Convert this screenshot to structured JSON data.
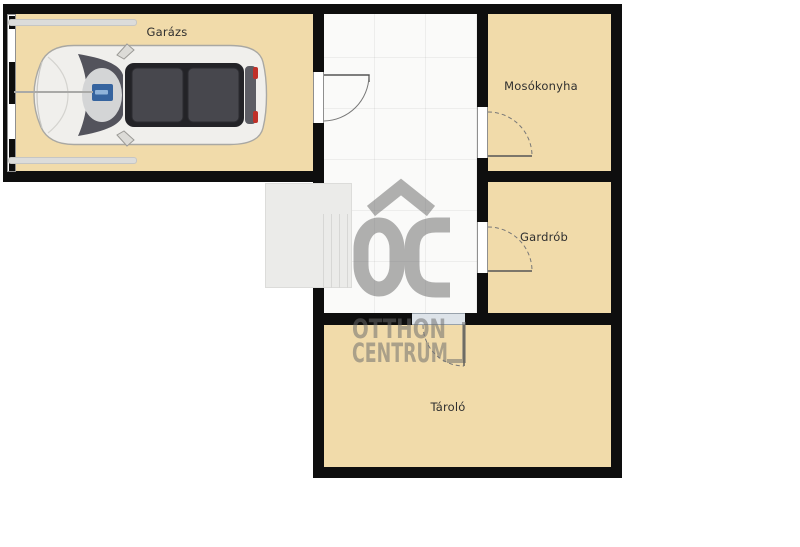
{
  "floorplan": {
    "rooms": [
      {
        "key": "garage",
        "label": "Garázs"
      },
      {
        "key": "laundry",
        "label": "Mosókonyha"
      },
      {
        "key": "wardrobe",
        "label": "Gardrób"
      },
      {
        "key": "storage",
        "label": "Tároló"
      }
    ],
    "watermark": {
      "logo": "OC",
      "line1": "OTTHON",
      "line2": "CENTRUM"
    },
    "colors": {
      "room_fill": "#f1dbaa",
      "wall": "#0e0e0e",
      "hall_fill": "#fafaf9",
      "stairs_fill": "#ebebe9",
      "jamb_fill": "#ffffff",
      "storage_jamb_fill": "#dde3e9",
      "door_line": "#555555",
      "watermark": "#6b6b6b",
      "label_text": "#2f2f2f"
    }
  }
}
